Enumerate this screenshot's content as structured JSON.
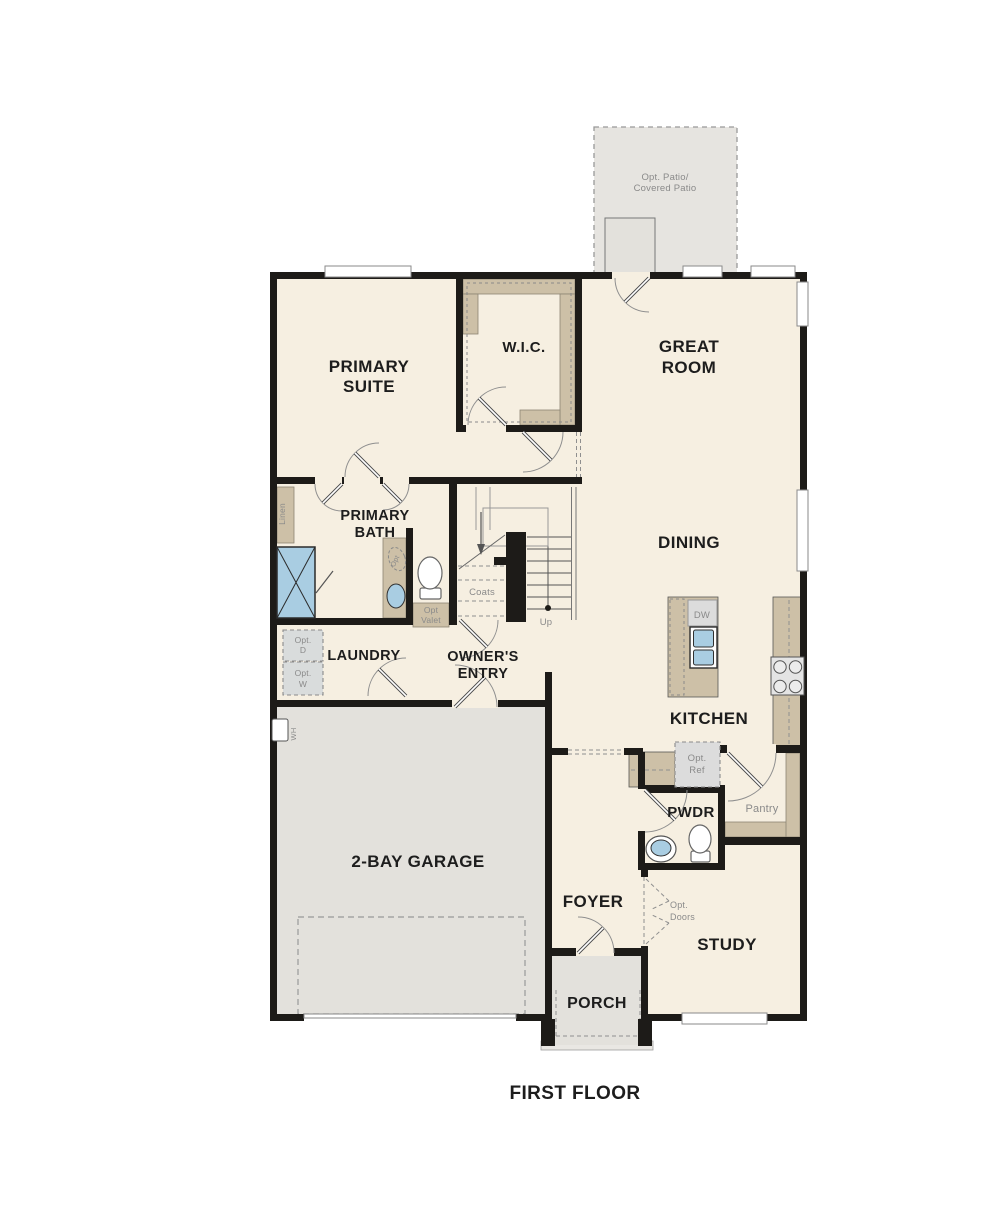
{
  "plan": {
    "caption": "FIRST FLOOR",
    "rooms": {
      "patio_line1": "Opt. Patio/",
      "patio_line2": "Covered Patio",
      "primary_suite_line1": "PRIMARY",
      "primary_suite_line2": "SUITE",
      "wic": "W.I.C.",
      "great_room_line1": "GREAT",
      "great_room_line2": "ROOM",
      "primary_bath_line1": "PRIMARY",
      "primary_bath_line2": "BATH",
      "dining": "DINING",
      "laundry": "LAUNDRY",
      "owners_entry_line1": "OWNER'S",
      "owners_entry_line2": "ENTRY",
      "kitchen": "KITCHEN",
      "garage": "2-BAY GARAGE",
      "pwdr": "PWDR",
      "pantry": "Pantry",
      "foyer": "FOYER",
      "study": "STUDY",
      "porch": "PORCH"
    },
    "annotations": {
      "linen": "Linen",
      "coats": "Coats",
      "up": "Up",
      "opt_valet_line1": "Opt",
      "opt_valet_line2": "Valet",
      "opt_d_line1": "Opt.",
      "opt_d_line2": "D",
      "opt_w_line1": "Opt.",
      "opt_w_line2": "W",
      "wh": "WH",
      "dw": "DW",
      "opt_ref_line1": "Opt.",
      "opt_ref_line2": "Ref",
      "opt_doors_line1": "Opt.",
      "opt_doors_line2": "Doors",
      "opt_sink": "Opt"
    },
    "colors": {
      "wall": "#1d1b18",
      "floor": "#f6efe1",
      "exterior_floor": "#e3e1dc",
      "patio_floor": "#e6e4e0",
      "cabinet_tan": "#cdc0a7",
      "fixture_blue": "#a9cde2",
      "appliance_grey": "#dcdcdc",
      "label_dark": "#1d1d1d",
      "label_grey": "#8a8a8a"
    }
  }
}
